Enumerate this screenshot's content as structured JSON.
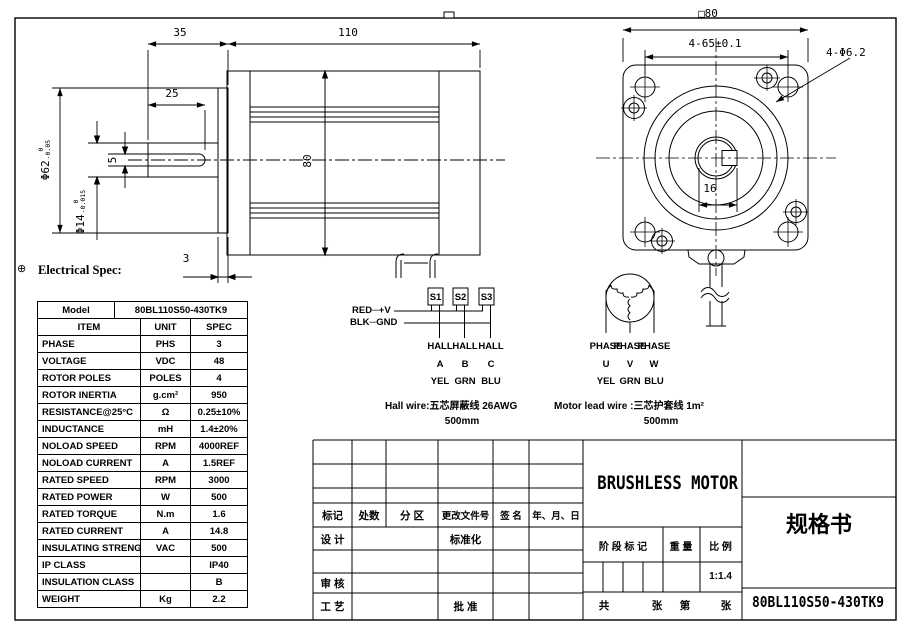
{
  "frame": {
    "center_mark": "⊕"
  },
  "views": {
    "side": {
      "dim_35": "35",
      "dim_110": "110",
      "dim_25": "25",
      "dim_phi62": "Φ62",
      "phi62_tol_top": "0",
      "phi62_tol_bot": "-0.05",
      "dim_phi14": "Φ14",
      "phi14_tol_top": "0",
      "phi14_tol_bot": "-0.015",
      "dim_5": "5",
      "dim_3": "3",
      "dim_80": "80"
    },
    "front": {
      "dim_square": "□80",
      "dim_bolt_circle": "4-65±0.1",
      "dim_holes": "4-Φ6.2",
      "dim_key": "16"
    }
  },
  "spec": {
    "heading": "Electrical Spec:",
    "model_label": "Model",
    "model_value": "80BL110S50-430TK9",
    "headers": [
      "ITEM",
      "UNIT",
      "SPEC"
    ],
    "rows": [
      [
        "PHASE",
        "PHS",
        "3"
      ],
      [
        "VOLTAGE",
        "VDC",
        "48"
      ],
      [
        "ROTOR POLES",
        "POLES",
        "4"
      ],
      [
        "ROTOR INERTIA",
        "g.cm²",
        "950"
      ],
      [
        "RESISTANCE@25°C",
        "Ω",
        "0.25±10%"
      ],
      [
        "INDUCTANCE",
        "mH",
        "1.4±20%"
      ],
      [
        "NOLOAD SPEED",
        "RPM",
        "4000REF"
      ],
      [
        "NOLOAD CURRENT",
        "A",
        "1.5REF"
      ],
      [
        "RATED SPEED",
        "RPM",
        "3000"
      ],
      [
        "RATED POWER",
        "W",
        "500"
      ],
      [
        "RATED TORQUE",
        "N.m",
        "1.6"
      ],
      [
        "RATED CURRENT",
        "A",
        "14.8"
      ],
      [
        "INSULATING STRENGTH",
        "VAC",
        "500"
      ],
      [
        "IP CLASS",
        "",
        "IP40"
      ],
      [
        "INSULATION CLASS",
        "",
        "B"
      ],
      [
        "WEIGHT",
        "Kg",
        "2.2"
      ]
    ]
  },
  "hall": {
    "sensors": [
      "S1",
      "S2",
      "S3"
    ],
    "red": "RED─+V",
    "blk": "BLK─GND",
    "row1": [
      "HALL",
      "HALL",
      "HALL"
    ],
    "row2": [
      "A",
      "B",
      "C"
    ],
    "row3": [
      "YEL",
      "GRN",
      "BLU"
    ],
    "note": "Hall wire:五芯屏蔽线 26AWG",
    "length": "500mm"
  },
  "lead": {
    "row1": [
      "PHASE",
      "PHASE",
      "PHASE"
    ],
    "row2": [
      "U",
      "V",
      "W"
    ],
    "row3": [
      "YEL",
      "GRN",
      "BLU"
    ],
    "note": "Motor lead wire :三芯护套线 1m²",
    "length": "500mm"
  },
  "title_block": {
    "rev_headers": [
      "标记",
      "处数",
      "分 区",
      "更改文件号",
      "签 名",
      "年、月、日"
    ],
    "design": "设 计",
    "standardization": "标准化",
    "review": "审 核",
    "process": "工 艺",
    "approve": "批 准",
    "product_title": "BRUSHLESS MOTOR",
    "stage": "阶 段 标 记",
    "weight": "重 量",
    "scale": "比 例",
    "scale_value": "1:1.4",
    "sheet_total": "共",
    "sheet_unit1": "张",
    "sheet_no": "第",
    "sheet_unit2": "张",
    "doc_type": "规格书",
    "part_number": "80BL110S50-430TK9"
  }
}
